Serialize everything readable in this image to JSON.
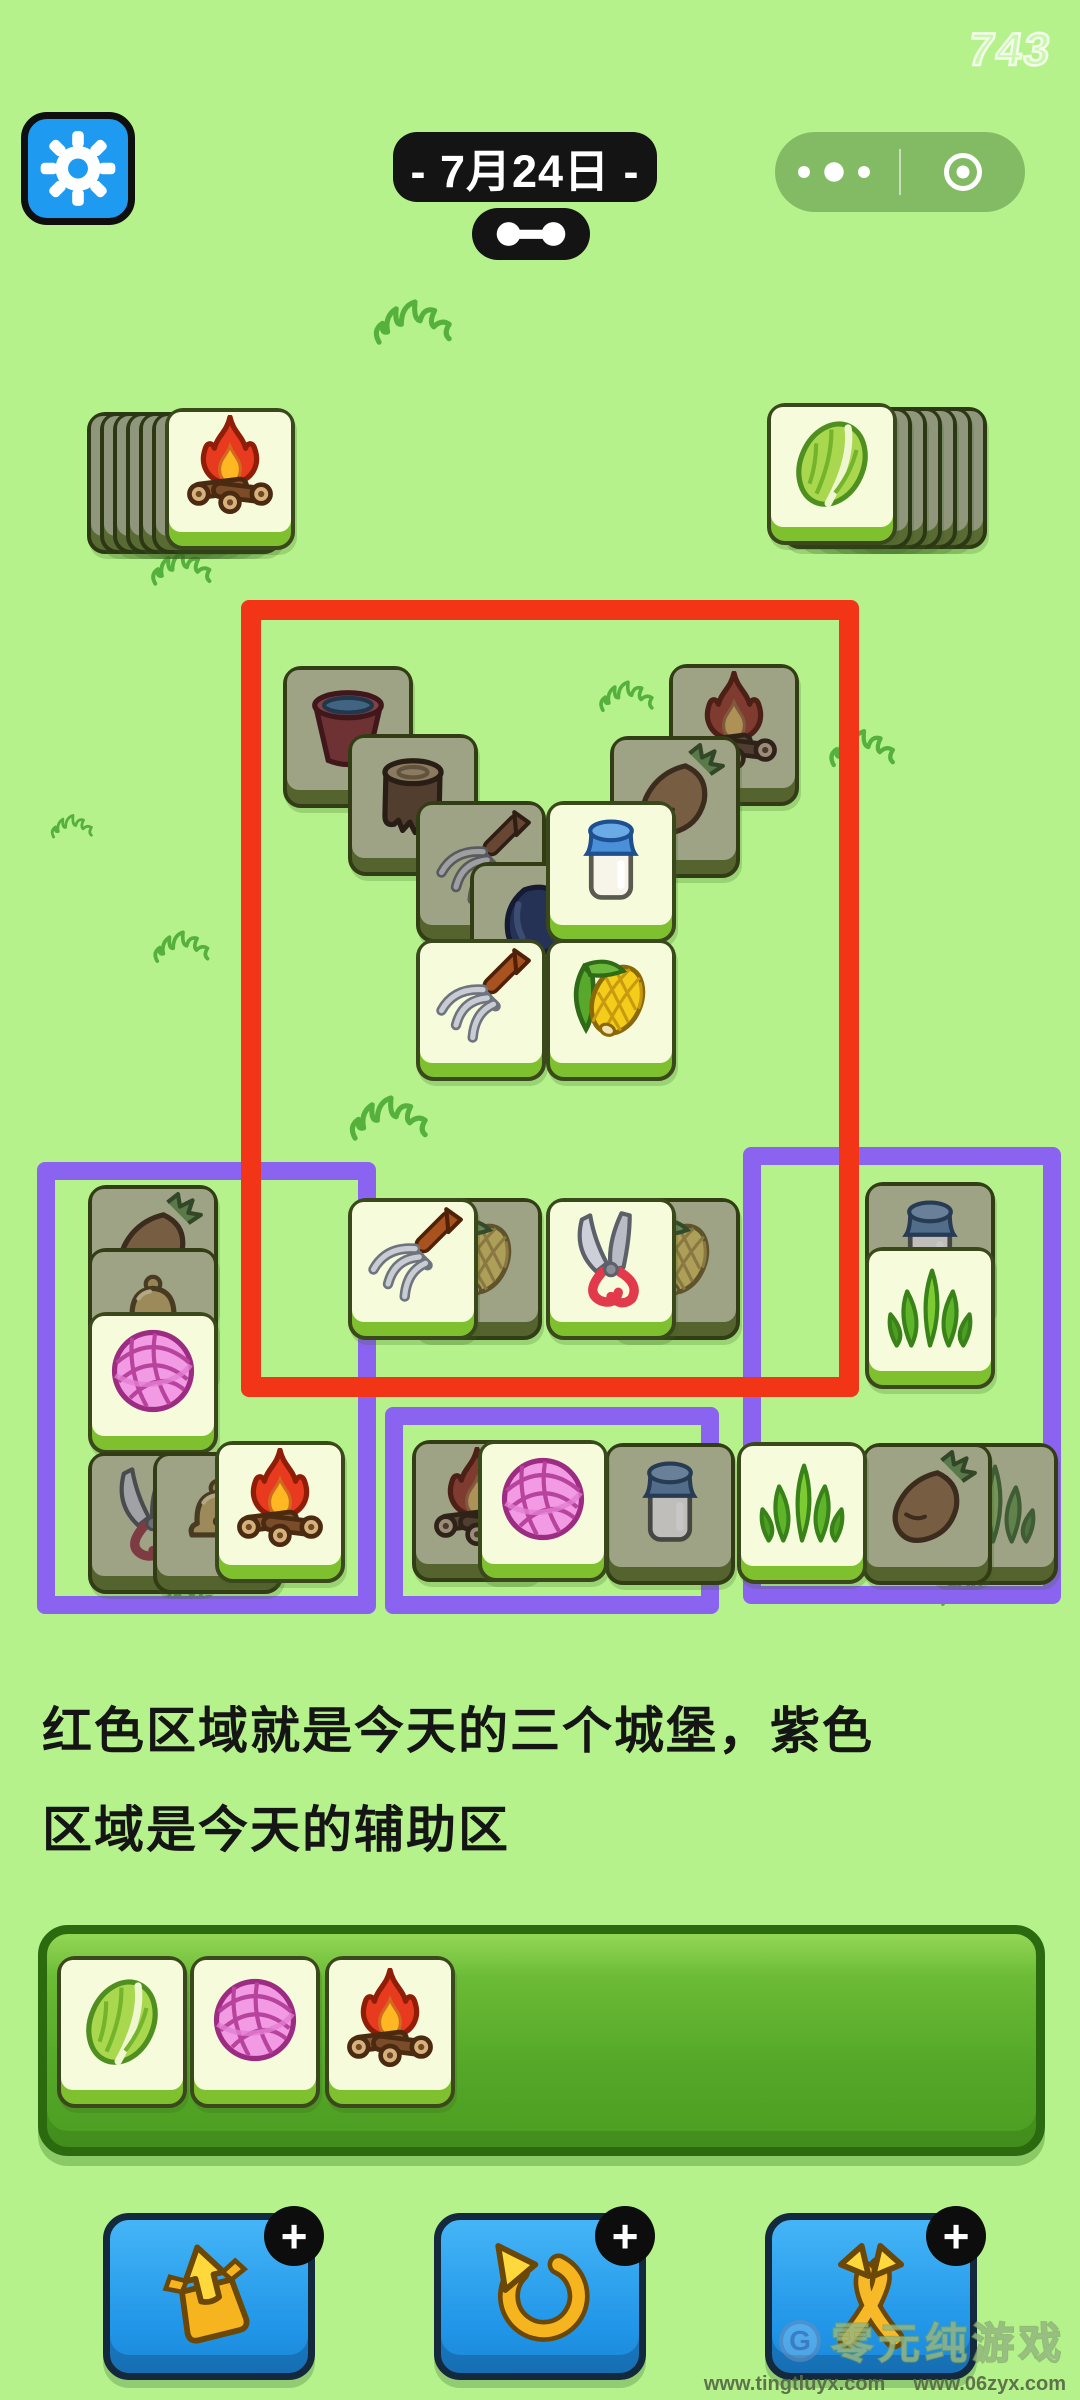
{
  "app": {
    "counter": "743"
  },
  "header": {
    "date_label": "- 7月24日 -",
    "settings_icon": "gear-icon",
    "link_icon": "dumbbell-icon",
    "capsule_more_icon": "more-dots-icon",
    "capsule_home_icon": "home-target-icon"
  },
  "caption": {
    "line1": "红色区域就是今天的三个城堡，紫色",
    "line2": "区域是今天的辅助区"
  },
  "colors": {
    "background": "#b5f28c",
    "red_zone": "#f23517",
    "purple_zone": "#8b63f1",
    "tile_face": "#f5fbdb",
    "tile_face_dim": "#9da384",
    "tile_back": "#8f967b",
    "tray_green": "#55a828",
    "button_blue": "#2aa2ee",
    "badge_black": "#0d0d0d"
  },
  "board": {
    "regions": [
      {
        "name": "zone-purple-left",
        "kind": "purple",
        "x": 37,
        "y": 1162,
        "w": 303,
        "h": 416
      },
      {
        "name": "zone-purple-middle",
        "kind": "purple",
        "x": 385,
        "y": 1407,
        "w": 298,
        "h": 171
      },
      {
        "name": "zone-purple-right",
        "kind": "purple",
        "x": 743,
        "y": 1147,
        "w": 282,
        "h": 421
      },
      {
        "name": "zone-red-castles",
        "kind": "red",
        "x": 241,
        "y": 600,
        "w": 578,
        "h": 757
      }
    ],
    "decor_grass": [
      {
        "x": 372,
        "y": 296,
        "s": 86
      },
      {
        "x": 150,
        "y": 548,
        "s": 66
      },
      {
        "x": 598,
        "y": 678,
        "s": 60
      },
      {
        "x": 828,
        "y": 726,
        "s": 72
      },
      {
        "x": 50,
        "y": 812,
        "s": 46
      },
      {
        "x": 152,
        "y": 928,
        "s": 62
      },
      {
        "x": 348,
        "y": 1092,
        "s": 86
      },
      {
        "x": 158,
        "y": 1578,
        "s": 62
      },
      {
        "x": 938,
        "y": 1572,
        "s": 60
      }
    ],
    "tiles": [
      {
        "icon": "back",
        "x": 87,
        "y": 412,
        "state": "back",
        "zone": "deck-left"
      },
      {
        "icon": "back",
        "x": 100,
        "y": 412,
        "state": "back",
        "zone": "deck-left"
      },
      {
        "icon": "back",
        "x": 113,
        "y": 412,
        "state": "back",
        "zone": "deck-left"
      },
      {
        "icon": "back",
        "x": 126,
        "y": 412,
        "state": "back",
        "zone": "deck-left"
      },
      {
        "icon": "back",
        "x": 139,
        "y": 412,
        "state": "back",
        "zone": "deck-left"
      },
      {
        "icon": "back",
        "x": 152,
        "y": 412,
        "state": "back",
        "zone": "deck-left"
      },
      {
        "icon": "fire",
        "x": 165,
        "y": 408,
        "state": "bright",
        "zone": "deck-left"
      },
      {
        "icon": "back",
        "x": 857,
        "y": 407,
        "state": "back",
        "zone": "deck-right"
      },
      {
        "icon": "back",
        "x": 842,
        "y": 407,
        "state": "back",
        "zone": "deck-right"
      },
      {
        "icon": "back",
        "x": 827,
        "y": 407,
        "state": "back",
        "zone": "deck-right"
      },
      {
        "icon": "back",
        "x": 812,
        "y": 407,
        "state": "back",
        "zone": "deck-right"
      },
      {
        "icon": "back",
        "x": 797,
        "y": 407,
        "state": "back",
        "zone": "deck-right"
      },
      {
        "icon": "back",
        "x": 782,
        "y": 407,
        "state": "back",
        "zone": "deck-right"
      },
      {
        "icon": "cabbage",
        "x": 767,
        "y": 403,
        "state": "bright",
        "zone": "deck-right"
      },
      {
        "icon": "bucket",
        "x": 283,
        "y": 666,
        "state": "dim",
        "zone": "castle"
      },
      {
        "icon": "fire",
        "x": 669,
        "y": 664,
        "state": "dim",
        "zone": "castle"
      },
      {
        "icon": "stump",
        "x": 348,
        "y": 734,
        "state": "dim",
        "zone": "castle"
      },
      {
        "icon": "carrot",
        "x": 610,
        "y": 736,
        "state": "dim",
        "zone": "castle"
      },
      {
        "icon": "pitchfork",
        "x": 416,
        "y": 801,
        "state": "dim",
        "zone": "castle"
      },
      {
        "icon": "can",
        "x": 470,
        "y": 862,
        "state": "dim",
        "zone": "castle"
      },
      {
        "icon": "milk",
        "x": 546,
        "y": 801,
        "state": "bright",
        "zone": "castle"
      },
      {
        "icon": "pitchfork",
        "x": 416,
        "y": 939,
        "state": "bright",
        "zone": "castle"
      },
      {
        "icon": "corn",
        "x": 546,
        "y": 939,
        "state": "bright",
        "zone": "castle"
      },
      {
        "icon": "corn",
        "x": 412,
        "y": 1198,
        "state": "dim",
        "zone": "castle"
      },
      {
        "icon": "pitchfork",
        "x": 348,
        "y": 1198,
        "state": "bright",
        "zone": "castle"
      },
      {
        "icon": "corn",
        "x": 610,
        "y": 1198,
        "state": "dim",
        "zone": "castle"
      },
      {
        "icon": "shears",
        "x": 546,
        "y": 1198,
        "state": "bright",
        "zone": "castle"
      },
      {
        "icon": "carrot",
        "x": 88,
        "y": 1185,
        "state": "dim",
        "zone": "aux-left"
      },
      {
        "icon": "bell",
        "x": 88,
        "y": 1248,
        "state": "dim",
        "zone": "aux-left"
      },
      {
        "icon": "yarn",
        "x": 88,
        "y": 1312,
        "state": "bright",
        "zone": "aux-left"
      },
      {
        "icon": "shears",
        "x": 88,
        "y": 1452,
        "state": "dim",
        "zone": "aux-left"
      },
      {
        "icon": "bell",
        "x": 153,
        "y": 1452,
        "state": "dim",
        "zone": "aux-left"
      },
      {
        "icon": "fire",
        "x": 215,
        "y": 1441,
        "state": "bright",
        "zone": "aux-left"
      },
      {
        "icon": "fire",
        "x": 412,
        "y": 1440,
        "state": "dim",
        "zone": "aux-middle"
      },
      {
        "icon": "milk",
        "x": 605,
        "y": 1443,
        "state": "dim",
        "zone": "aux-middle"
      },
      {
        "icon": "yarn",
        "x": 478,
        "y": 1440,
        "state": "bright",
        "zone": "aux-middle"
      },
      {
        "icon": "milk",
        "x": 865,
        "y": 1182,
        "state": "dim",
        "zone": "aux-right"
      },
      {
        "icon": "grass",
        "x": 865,
        "y": 1247,
        "state": "bright",
        "zone": "aux-right"
      },
      {
        "icon": "grass",
        "x": 928,
        "y": 1443,
        "state": "dim",
        "zone": "aux-right"
      },
      {
        "icon": "carrot",
        "x": 862,
        "y": 1443,
        "state": "dim",
        "zone": "aux-right"
      },
      {
        "icon": "grass",
        "x": 737,
        "y": 1442,
        "state": "bright",
        "zone": "aux-right"
      },
      {
        "icon": "cabbage",
        "x": 57,
        "y": 1956,
        "state": "bright",
        "zone": "tray"
      },
      {
        "icon": "yarn",
        "x": 190,
        "y": 1956,
        "state": "bright",
        "zone": "tray"
      },
      {
        "icon": "fire",
        "x": 325,
        "y": 1956,
        "state": "bright",
        "zone": "tray"
      }
    ]
  },
  "toolbar": {
    "plus_badge": "+",
    "buttons": [
      {
        "name": "eject-prop-button",
        "icon": "eject-icon"
      },
      {
        "name": "undo-prop-button",
        "icon": "undo-icon"
      },
      {
        "name": "shuffle-prop-button",
        "icon": "shuffle-icon"
      }
    ]
  },
  "watermark": {
    "logo_letter": "G",
    "brand": "零元纯游戏",
    "url1": "www.tingtluyx.com",
    "url2": "www.06zyx.com"
  }
}
